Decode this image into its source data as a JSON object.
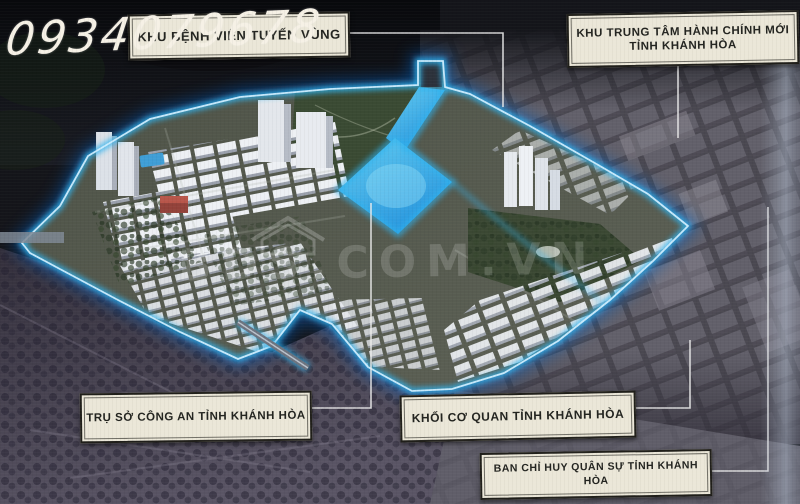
{
  "watermarks": {
    "phone": "0934079678",
    "brand": "BDS.COM.VN"
  },
  "annotations": {
    "hospital": {
      "label": "KHU BỆNH VIỆN TUYẾN VÙNG"
    },
    "admin_center": {
      "line1": "KHU TRUNG TÂM HÀNH CHÍNH MỚI",
      "line2": "TỈNH KHÁNH HÒA"
    },
    "police_hq": {
      "label": "TRỤ SỞ CÔNG AN TỈNH KHÁNH HÒA"
    },
    "provincial_agencies": {
      "label": "KHỐI CƠ QUAN TỈNH KHÁNH HÒA"
    },
    "military_command": {
      "label": "BAN CHỈ HUY QUÂN SỰ TỈNH KHÁNH HÒA"
    }
  },
  "colors": {
    "glow_blue": "#2fb4f0",
    "glow_core": "#cfeeff",
    "deep_glow": "#0f5fc0",
    "water_light": "#63cdf2",
    "water_deep": "#2795dd",
    "label_bg": "#ebe7d8",
    "phone_color": "#f6f1e6"
  }
}
